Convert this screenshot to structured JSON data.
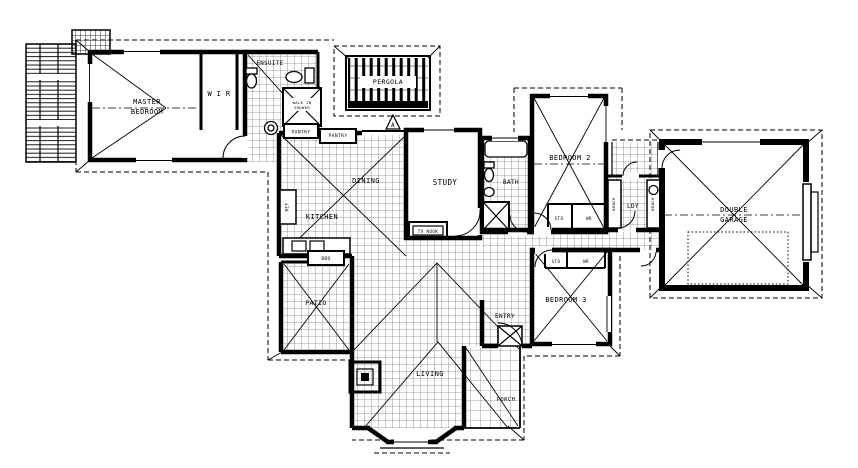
{
  "drawing": {
    "type": "architectural-floor-plan",
    "description": "Single storey residential house plan with pergola, patio, porch and double garage",
    "ink_color": "#000000",
    "paper_color": "#ffffff"
  },
  "labels": [
    {
      "id": "master-1",
      "text": "MASTER",
      "x": 147,
      "y": 104,
      "size": 7
    },
    {
      "id": "master-2",
      "text": "BEDROOM",
      "x": 147,
      "y": 114,
      "size": 7
    },
    {
      "id": "wir",
      "text": "W I R",
      "x": 219,
      "y": 96,
      "size": 7
    },
    {
      "id": "ensuite",
      "text": "ENSUITE",
      "x": 270,
      "y": 65,
      "size": 5.8
    },
    {
      "id": "walkin-1",
      "text": "WALK IN",
      "x": 302,
      "y": 104,
      "size": 3.8
    },
    {
      "id": "walkin-2",
      "text": "SHOWER",
      "x": 302,
      "y": 109,
      "size": 3.8
    },
    {
      "id": "pantry-1",
      "text": "PANTRY",
      "x": 301,
      "y": 133.5,
      "size": 4.6
    },
    {
      "id": "pantry-2",
      "text": "PANTRY",
      "x": 338,
      "y": 137,
      "size": 4.6
    },
    {
      "id": "pergola",
      "text": "PERGOLA",
      "x": 388,
      "y": 84,
      "size": 6.5
    },
    {
      "id": "dining",
      "text": "DINING",
      "x": 366,
      "y": 183,
      "size": 7
    },
    {
      "id": "kitchen",
      "text": "KITCHEN",
      "x": 322,
      "y": 219,
      "size": 7
    },
    {
      "id": "ref",
      "text": "REF",
      "x": 288.5,
      "y": 207,
      "size": 4.2,
      "rot": -90
    },
    {
      "id": "study",
      "text": "STUDY",
      "x": 445,
      "y": 185,
      "size": 7.5
    },
    {
      "id": "tv-nook",
      "text": "TV NOOK",
      "x": 428,
      "y": 233,
      "size": 4.2
    },
    {
      "id": "bath",
      "text": "BATH",
      "x": 511,
      "y": 184,
      "size": 6
    },
    {
      "id": "bedroom2",
      "text": "BEDROOM 2",
      "x": 570,
      "y": 160,
      "size": 7
    },
    {
      "id": "sto-bed2",
      "text": "STO",
      "x": 559,
      "y": 220,
      "size": 4.2
    },
    {
      "id": "wr-bed2",
      "text": "WR",
      "x": 589,
      "y": 220,
      "size": 4.2
    },
    {
      "id": "ldy",
      "text": "LDY",
      "x": 633,
      "y": 208,
      "size": 6
    },
    {
      "id": "bench-left",
      "text": "BENCH",
      "x": 615,
      "y": 204,
      "size": 3.8,
      "rot": -90
    },
    {
      "id": "bench-right",
      "text": "BENCH",
      "x": 654,
      "y": 204,
      "size": 3.8,
      "rot": -90
    },
    {
      "id": "garage-1",
      "text": "DOUBLE",
      "x": 734,
      "y": 212,
      "size": 7
    },
    {
      "id": "garage-2",
      "text": "GARAGE",
      "x": 734,
      "y": 222,
      "size": 7
    },
    {
      "id": "sto-bed3",
      "text": "STO",
      "x": 556,
      "y": 263,
      "size": 4.2
    },
    {
      "id": "wr-bed3",
      "text": "WR",
      "x": 586,
      "y": 263,
      "size": 4.2
    },
    {
      "id": "bedroom3",
      "text": "BEDROOM 3",
      "x": 566,
      "y": 302,
      "size": 7
    },
    {
      "id": "entry",
      "text": "ENTRY",
      "x": 505,
      "y": 318,
      "size": 6
    },
    {
      "id": "porch",
      "text": "PORCH",
      "x": 506,
      "y": 401,
      "size": 5.5
    },
    {
      "id": "patio",
      "text": "PATIO",
      "x": 316,
      "y": 305,
      "size": 6.5
    },
    {
      "id": "living",
      "text": "LIVING",
      "x": 430,
      "y": 376,
      "size": 7
    },
    {
      "id": "bbq",
      "text": "BBQ",
      "x": 326,
      "y": 260,
      "size": 4.5
    },
    {
      "id": "section-a",
      "text": "A",
      "x": 393,
      "y": 127,
      "size": 6
    }
  ]
}
